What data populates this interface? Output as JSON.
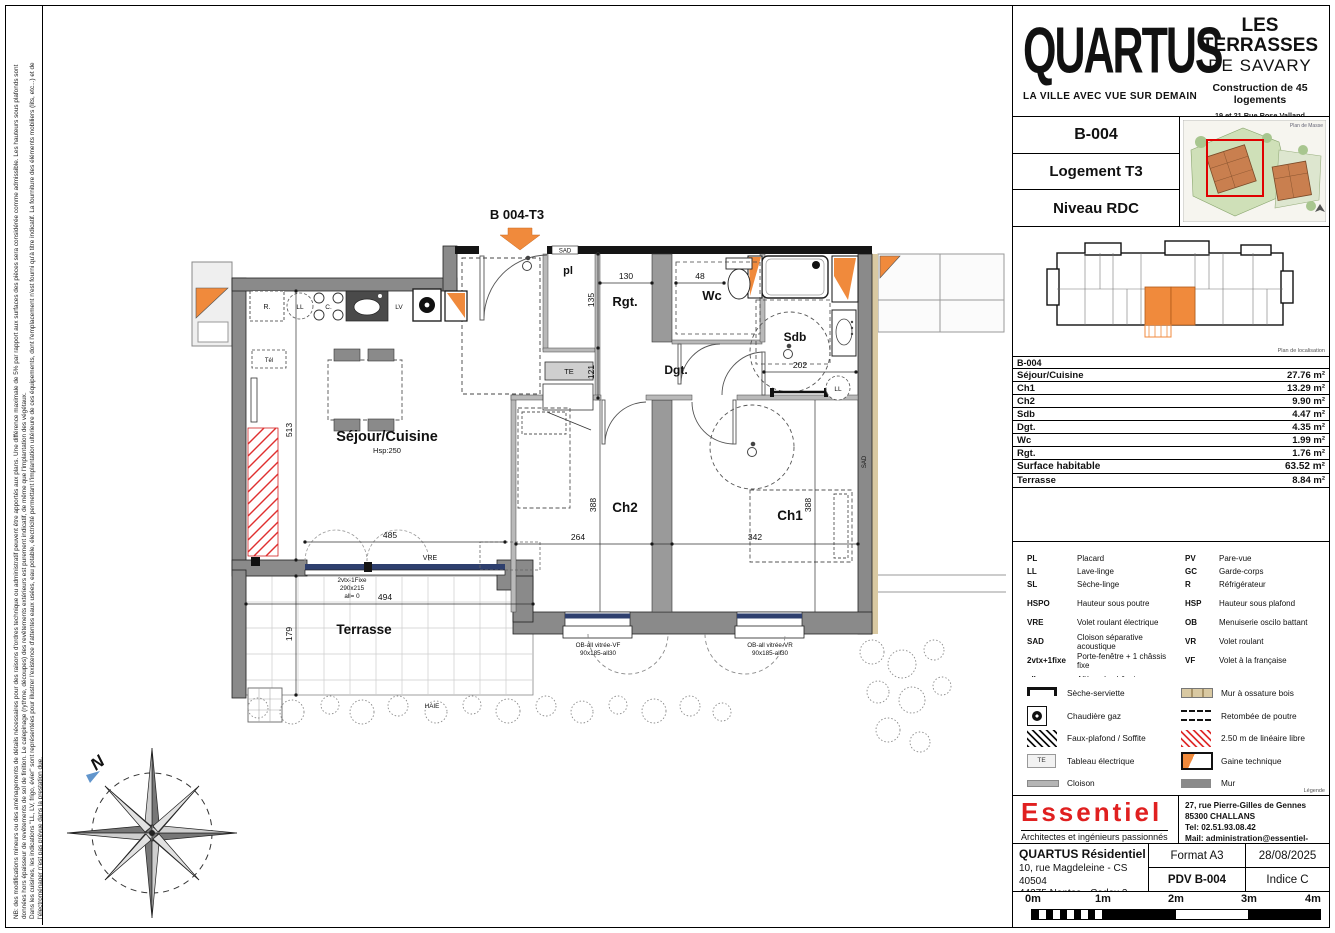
{
  "side_notes": {
    "l1": "NB: des modifications mineurs ou des aménagements de détails nécessaires pour des raisons d'ordres technique ou administratif peuvent être apportés aux plans. Une différence maximale de 5% par rapport aux surfaces des pièces sera considérée comme admissible. Les hauteurs sous plafonds sont",
    "l2": "données hors épaisseur de revêtements de sol de finition. Le calepinage (rythme, découpes) des revêtements extérieurs est purement indicatif, de même que l'implantation des végétaux.",
    "l3": "Dans les cuisines, les indications \"LL, LV, frigo, évier\" sont représentées pour illustrer l'existence d'attentes eaux usées, eau potable, électricité permettant l'implantation ultérieure de ces équipements, dont l'emplacement n'est fourni qu'à titre indicatif. La fourniture des éléments mobiliers (lits, etc...) et de",
    "l4": "l'électroménager n'est pas prévue dans la prestation due."
  },
  "header": {
    "logo_title": "QUARTUS",
    "logo_tagline": "LA VILLE AVEC VUE SUR DEMAIN",
    "project_title1": "LES TERRASSES",
    "project_title2": "DE SAVARY",
    "project_subtitle": "Construction de 45 logements",
    "address1": "19 et 21 Rue Rose Valland",
    "address2": "Lotissement les Moinardes",
    "address3": "85340 LES SABLES D'OLONNE"
  },
  "unit": {
    "code": "B-004",
    "type": "Logement T3",
    "level": "Niveau RDC"
  },
  "site": {
    "masse_caption": "Plan de Masse",
    "loc_caption": "Plan de localisation"
  },
  "areas": {
    "header": "B-004",
    "rows": [
      {
        "label": "Séjour/Cuisine",
        "value": "27.76 m²"
      },
      {
        "label": "Ch1",
        "value": "13.29 m²"
      },
      {
        "label": "Ch2",
        "value": "9.90 m²"
      },
      {
        "label": "Sdb",
        "value": "4.47 m²"
      },
      {
        "label": "Dgt.",
        "value": "4.35 m²"
      },
      {
        "label": "Wc",
        "value": "1.99 m²"
      },
      {
        "label": "Rgt.",
        "value": "1.76 m²"
      }
    ],
    "total_label": "Surface habitable",
    "total_value": "63.52 m²",
    "extra_label": "Terrasse",
    "extra_value": "8.84 m²"
  },
  "abbrev": {
    "left": [
      {
        "a": "PL",
        "d": "Placard"
      },
      {
        "a": "LL",
        "d": "Lave-linge"
      },
      {
        "a": "SL",
        "d": "Sèche-linge"
      },
      {
        "a": "HSPO",
        "d": "Hauteur sous poutre"
      },
      {
        "a": "VRE",
        "d": "Volet roulant électrique"
      },
      {
        "a": "SAD",
        "d": "Cloison séparative acoustique"
      },
      {
        "a": "2vtx+1fixe",
        "d": "Porte-fenêtre + 1 châssis fixe"
      },
      {
        "a": "all",
        "d": "Allège du châssis"
      }
    ],
    "right": [
      {
        "a": "PV",
        "d": "Pare-vue"
      },
      {
        "a": "GC",
        "d": "Garde-corps"
      },
      {
        "a": "R",
        "d": "Réfrigérateur"
      },
      {
        "a": "HSP",
        "d": "Hauteur sous plafond"
      },
      {
        "a": "OB",
        "d": "Menuiserie oscilo battant"
      },
      {
        "a": "VR",
        "d": "Volet roulant"
      },
      {
        "a": "VF",
        "d": "Volet à la française"
      }
    ]
  },
  "symbols": {
    "left": [
      "Sèche-serviette",
      "Chaudière gaz",
      "Faux-plafond / Soffite",
      "Tableau électrique",
      "Cloison"
    ],
    "right": [
      "Mur à ossature bois",
      "Retombée de poutre",
      "2.50 m de linéaire libre",
      "Gaine technique",
      "Mur"
    ],
    "te": "TE",
    "caption": "Légende"
  },
  "architect": {
    "name": "Essentiel",
    "tagline": "Architectes et ingénieurs passionnés",
    "address1": "27, rue Pierre-Gilles de Gennes",
    "address2": "85300 CHALLANS",
    "tel": "Tel: 02.51.93.08.42",
    "mail": "Mail: administration@essentiel-archi.fr"
  },
  "titleblock": {
    "client": "QUARTUS Résidentiel",
    "client_address1": "10, rue Magdeleine - CS 40504",
    "client_address2": "44275 Nantes - Cedex 2",
    "format": "Format A3",
    "date": "28/08/2025",
    "pdv": "PDV B-004",
    "indice": "Indice C"
  },
  "scalebar": {
    "l0": "0m",
    "l1": "1m",
    "l2": "2m",
    "l3": "3m",
    "l4": "4m"
  },
  "plan": {
    "title": "B 004-T3",
    "rooms": {
      "sejour": "Séjour/Cuisine",
      "hsp": "Hsp:250",
      "pl": "pl",
      "rgt": "Rgt.",
      "wc": "Wc",
      "sdb": "Sdb",
      "dgt": "Dgt.",
      "ch1": "Ch1",
      "ch2": "Ch2",
      "terrasse": "Terrasse"
    },
    "fixtures": {
      "fridge": "R.",
      "hob": "C.",
      "dishwasher": "LV",
      "washer": "LL",
      "te": "TE",
      "tel": "Tél"
    },
    "dims": {
      "d130": "130",
      "d48": "48",
      "d135": "135",
      "d121": "121",
      "d202": "202",
      "d513": "513",
      "d485": "485",
      "d494": "494",
      "d179": "179",
      "d264": "264",
      "d342": "342",
      "d388": "388"
    },
    "windows": {
      "bay1": "2vtx-1Fixe",
      "bay2": "290x215",
      "bay3": "all= 0",
      "vre": "VRE",
      "ch2a": "OB-all vitrée-VF",
      "ch2b": "90x185-all30",
      "ch1a": "OB-all vitrée-VR",
      "ch1b": "90x185-all30"
    },
    "sad": "SAD",
    "haie": "HAIE",
    "north": "N"
  },
  "colors": {
    "accent_orange": "#f08a3c",
    "wall_gray": "#8a8a8a",
    "red_hatch": "#e03030",
    "window_blue": "#2e3f6e",
    "logo_red": "#e02020"
  }
}
